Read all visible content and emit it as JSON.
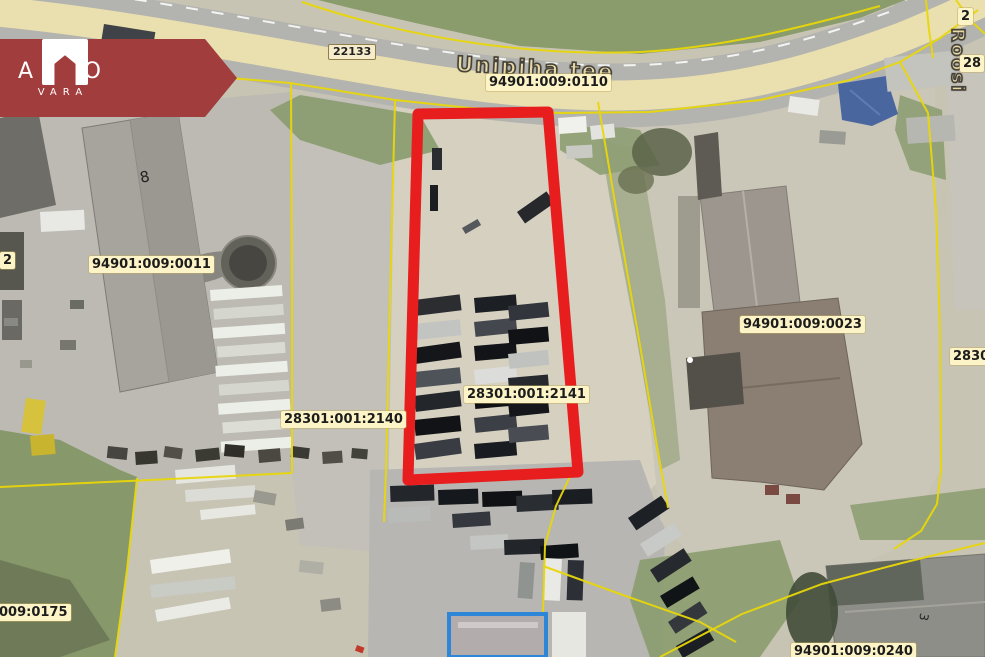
{
  "branding": {
    "name_line1": "ARCO",
    "name_line2": "VARA"
  },
  "map": {
    "streets": {
      "main": "Unipiha tee",
      "side": "Roosi",
      "route_number": "22133"
    },
    "parcel_labels": [
      {
        "text": "94901:009:0110"
      },
      {
        "text": "94901:009:0011"
      },
      {
        "text": "28301:001:2140"
      },
      {
        "text": "28301:001:2141"
      },
      {
        "text": "94901:009:0023"
      },
      {
        "text": "009:0175"
      },
      {
        "text": "94901:009:0240"
      },
      {
        "text": "2830"
      },
      {
        "text": "28"
      },
      {
        "text": "2"
      },
      {
        "text": "2"
      }
    ],
    "building_numbers": [
      {
        "text": "8"
      },
      {
        "text": "3"
      }
    ],
    "highlight": {
      "parcel": "28301:001:2141",
      "outline_color": "#e81d1d"
    },
    "colors": {
      "banner": "#a23d3d",
      "cadastral_line": "#e8d70a",
      "label_bg": "#fcf4c6",
      "road_fill": "#eadfae",
      "building_outline_blue": "#2e86d8"
    }
  }
}
